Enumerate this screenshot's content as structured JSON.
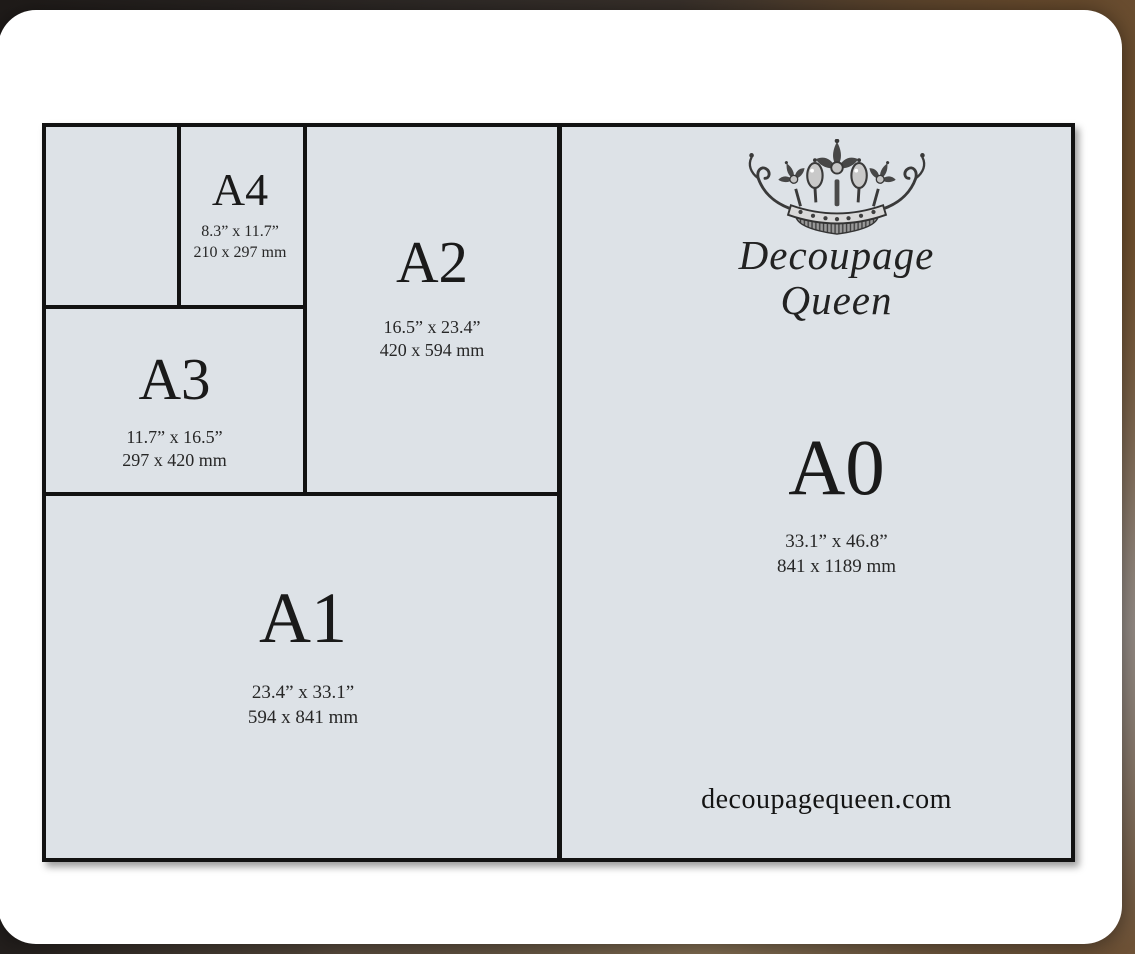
{
  "brand": {
    "name_line1": "Decoupage",
    "name_line2": "Queen",
    "website": "decoupagequeen.com",
    "crown_icon": "crown-icon"
  },
  "sizes": {
    "a4": {
      "label": "A4",
      "inches": "8.3” x 11.7”",
      "mm": "210 x 297 mm"
    },
    "a3": {
      "label": "A3",
      "inches": "11.7” x 16.5”",
      "mm": "297 x 420 mm"
    },
    "a2": {
      "label": "A2",
      "inches": "16.5” x 23.4”",
      "mm": "420 x 594 mm"
    },
    "a1": {
      "label": "A1",
      "inches": "23.4” x 33.1”",
      "mm": "594 x 841 mm"
    },
    "a0": {
      "label": "A0",
      "inches": "33.1” x 46.8”",
      "mm": "841 x 1189 mm"
    }
  },
  "colors": {
    "paper": "#dde2e7",
    "line": "#121212",
    "card": "#ffffff",
    "text": "#1a1a1a",
    "backdrop_brown": "#6e5236"
  }
}
